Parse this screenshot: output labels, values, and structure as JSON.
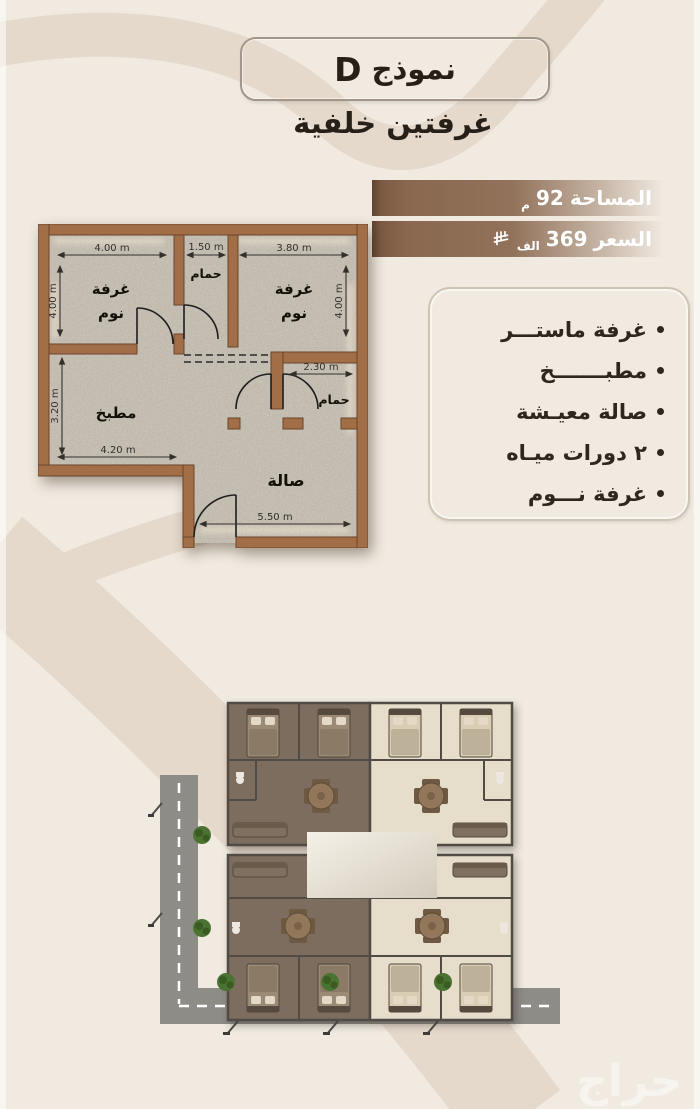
{
  "colors": {
    "background": "#f0eae1",
    "swoosh": "#e5d9cc",
    "badge_brown": "#8a6850",
    "wall_brown": "#a26e48",
    "text_dark": "#2a231c",
    "road_gray": "#8d8c87",
    "bush_green": "#4a7230"
  },
  "header": {
    "model_label": "نموذج",
    "model_letter": "D",
    "subtitle": "غرفتين خلفية"
  },
  "badges": {
    "area": {
      "label": "المساحة",
      "value": "92",
      "unit": "م"
    },
    "price": {
      "label": "السعر",
      "value": "369",
      "unit": "الف",
      "currency_icon": "saudi-riyal-symbol"
    }
  },
  "features": {
    "items": [
      "غرفة ماستـــر",
      "مطبـــــــخ",
      "صالة معيـشة",
      "٢ دورات ميـاه",
      "غرفة نـــوم"
    ]
  },
  "floorplan": {
    "room_labels": {
      "bedroom_line1": "غرفة",
      "bedroom_line2": "نوم",
      "bathroom": "حمام",
      "kitchen": "مطبخ",
      "hall": "صالة"
    },
    "dims": {
      "bedroom_left_width": "4.00 m",
      "bath_top_width": "1.50 m",
      "bedroom_right_width": "3.80 m",
      "bedroom_left_height": "4.00 m",
      "bedroom_right_height": "4.00 m",
      "kitchen_height": "3.20 m",
      "kitchen_width": "4.20 m",
      "hall_bath_width": "2.30 m",
      "hall_width": "5.50 m"
    }
  },
  "watermark": "حراج"
}
